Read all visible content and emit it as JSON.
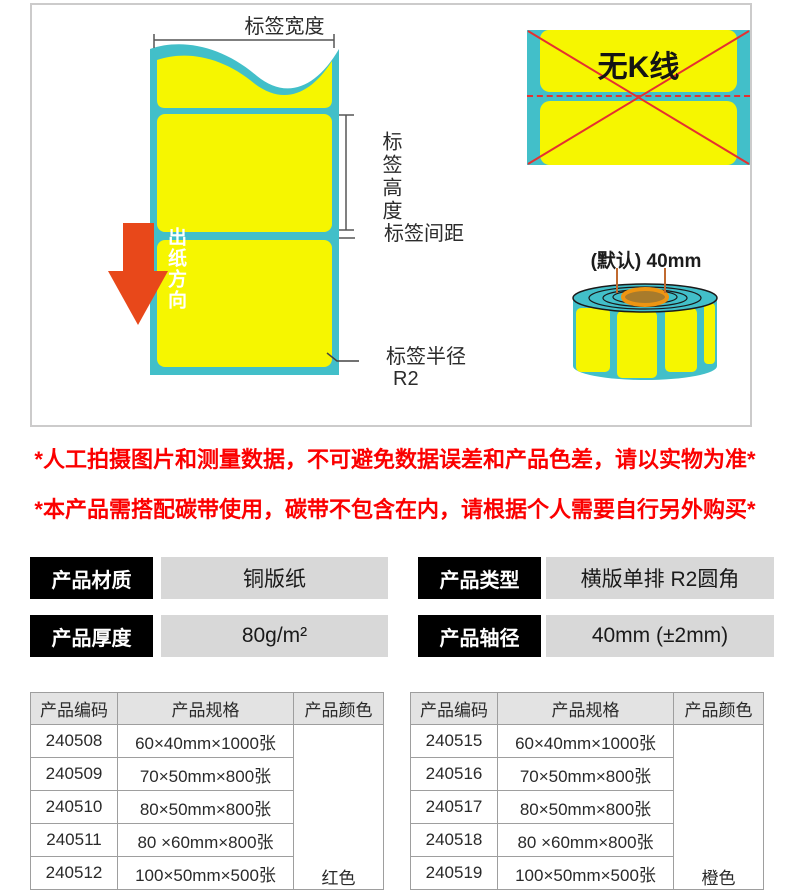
{
  "diagram": {
    "label_width": "标签宽度",
    "label_height": "标签高度",
    "label_gap": "标签间距",
    "label_radius_line1": "标签半径",
    "label_radius_line2": "R2",
    "paper_direction": "出纸方向",
    "no_k_line": "无K线",
    "core_default": "(默认) 40mm"
  },
  "warnings": [
    "*人工拍摄图片和测量数据，不可避免数据误差和产品色差，请以实物为准*",
    "*本产品需搭配碳带使用，碳带不包含在内，请根据个人需要自行另外购买*"
  ],
  "attributes": [
    {
      "label": "产品材质",
      "value": "铜版纸"
    },
    {
      "label": "产品类型",
      "value": "横版单排 R2圆角"
    },
    {
      "label": "产品厚度",
      "value": "80g/m²"
    },
    {
      "label": "产品轴径",
      "value": "40mm (±2mm)"
    }
  ],
  "tables": [
    {
      "headers": [
        "产品编码",
        "产品规格",
        "产品颜色"
      ],
      "rows": [
        [
          "240508",
          "60×40mm×1000张"
        ],
        [
          "240509",
          "70×50mm×800张"
        ],
        [
          "240510",
          "80×50mm×800张"
        ],
        [
          "240511",
          "80 ×60mm×800张"
        ],
        [
          "240512",
          "100×50mm×500张"
        ]
      ],
      "color": "红色"
    },
    {
      "headers": [
        "产品编码",
        "产品规格",
        "产品颜色"
      ],
      "rows": [
        [
          "240515",
          "60×40mm×1000张"
        ],
        [
          "240516",
          "70×50mm×800张"
        ],
        [
          "240517",
          "80×50mm×800张"
        ],
        [
          "240518",
          "80 ×60mm×800张"
        ],
        [
          "240519",
          "100×50mm×500张"
        ]
      ],
      "color": "橙色"
    }
  ],
  "colors": {
    "teal": "#42bfc9",
    "yellow": "#f6f600",
    "arrow_red": "#e8481a",
    "cross_red": "#e53030",
    "warning_red": "#fb0000",
    "core_ring": "#ee9512",
    "core_fill": "#a87b2b"
  }
}
